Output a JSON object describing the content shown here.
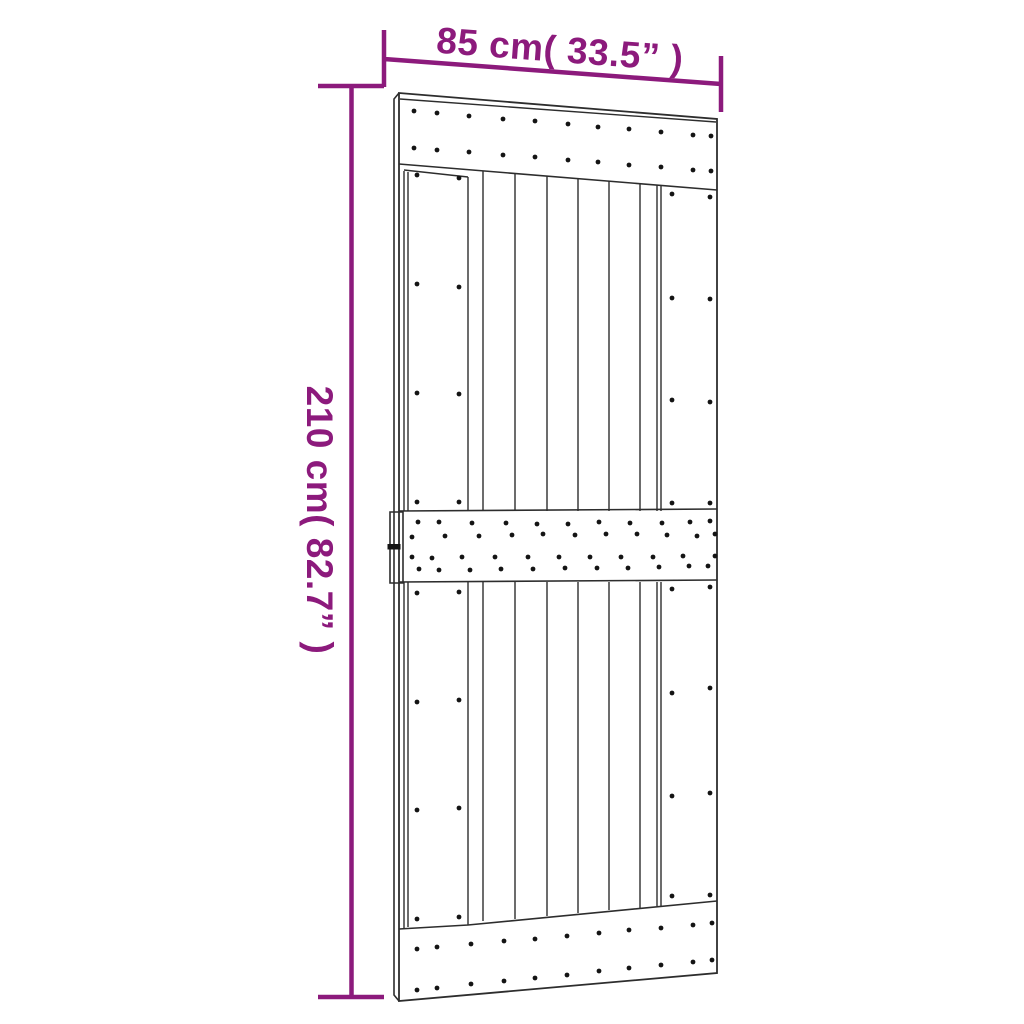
{
  "page": {
    "background": "#ffffff"
  },
  "colors": {
    "dimension": "#8c1a7c",
    "outline": "#2d2d2d",
    "screw": "#141414"
  },
  "dimensions": {
    "width": {
      "label": "85 cm( 33.5” )"
    },
    "height": {
      "label": "210 cm( 82.7” )"
    }
  },
  "door": {
    "screw_radius": 2.4,
    "screws": [
      {
        "name": "top-rail-row-1",
        "points": [
          [
            414,
            111
          ],
          [
            437,
            113
          ],
          [
            469,
            116
          ],
          [
            503,
            119
          ],
          [
            535,
            121
          ],
          [
            568,
            124
          ],
          [
            598,
            127
          ],
          [
            629,
            129
          ],
          [
            661,
            132
          ],
          [
            693,
            135
          ],
          [
            711,
            136
          ]
        ]
      },
      {
        "name": "top-rail-row-2",
        "points": [
          [
            414,
            148
          ],
          [
            437,
            150
          ],
          [
            469,
            152
          ],
          [
            503,
            155
          ],
          [
            535,
            157
          ],
          [
            568,
            160
          ],
          [
            598,
            162
          ],
          [
            629,
            165
          ],
          [
            661,
            167
          ],
          [
            693,
            170
          ],
          [
            711,
            171
          ]
        ]
      },
      {
        "name": "middle-rail-row-1",
        "points": [
          [
            418,
            522
          ],
          [
            439,
            522
          ],
          [
            472,
            523
          ],
          [
            506,
            523
          ],
          [
            537,
            524
          ],
          [
            568,
            524
          ],
          [
            599,
            522
          ],
          [
            630,
            523
          ],
          [
            662,
            523
          ],
          [
            690,
            522
          ],
          [
            710,
            521
          ]
        ]
      },
      {
        "name": "middle-rail-row-2",
        "points": [
          [
            412,
            537
          ],
          [
            445,
            536
          ],
          [
            479,
            536
          ],
          [
            512,
            535
          ],
          [
            543,
            534
          ],
          [
            575,
            535
          ],
          [
            606,
            534
          ],
          [
            637,
            534
          ],
          [
            667,
            535
          ],
          [
            697,
            536
          ],
          [
            715,
            534
          ]
        ]
      },
      {
        "name": "middle-rail-row-3",
        "points": [
          [
            412,
            557
          ],
          [
            432,
            558
          ],
          [
            462,
            557
          ],
          [
            495,
            557
          ],
          [
            528,
            557
          ],
          [
            559,
            557
          ],
          [
            590,
            557
          ],
          [
            621,
            557
          ],
          [
            653,
            557
          ],
          [
            683,
            556
          ],
          [
            715,
            556
          ]
        ]
      },
      {
        "name": "middle-rail-row-4",
        "points": [
          [
            419,
            569
          ],
          [
            439,
            570
          ],
          [
            470,
            570
          ],
          [
            501,
            569
          ],
          [
            533,
            569
          ],
          [
            565,
            568
          ],
          [
            597,
            568
          ],
          [
            628,
            568
          ],
          [
            659,
            567
          ],
          [
            689,
            566
          ],
          [
            708,
            566
          ]
        ]
      },
      {
        "name": "bottom-rail-row-1",
        "points": [
          [
            417,
            949
          ],
          [
            437,
            947
          ],
          [
            471,
            944
          ],
          [
            504,
            941
          ],
          [
            535,
            939
          ],
          [
            567,
            936
          ],
          [
            599,
            933
          ],
          [
            629,
            930
          ],
          [
            661,
            928
          ],
          [
            693,
            925
          ],
          [
            712,
            923
          ]
        ]
      },
      {
        "name": "bottom-rail-row-2",
        "points": [
          [
            417,
            990
          ],
          [
            437,
            988
          ],
          [
            471,
            984
          ],
          [
            504,
            981
          ],
          [
            535,
            978
          ],
          [
            567,
            975
          ],
          [
            599,
            971
          ],
          [
            629,
            968
          ],
          [
            661,
            965
          ],
          [
            693,
            962
          ],
          [
            712,
            960
          ]
        ]
      },
      {
        "name": "left-stile-upper",
        "points": [
          [
            417,
            175
          ],
          [
            459,
            178
          ],
          [
            417,
            284
          ],
          [
            459,
            287
          ],
          [
            417,
            393
          ],
          [
            459,
            394
          ],
          [
            417,
            502
          ],
          [
            459,
            502
          ]
        ]
      },
      {
        "name": "left-stile-lower",
        "points": [
          [
            417,
            593
          ],
          [
            459,
            592
          ],
          [
            417,
            702
          ],
          [
            459,
            700
          ],
          [
            417,
            810
          ],
          [
            459,
            808
          ],
          [
            417,
            919
          ],
          [
            459,
            917
          ]
        ]
      },
      {
        "name": "right-stile-upper",
        "points": [
          [
            672,
            194
          ],
          [
            710,
            197
          ],
          [
            672,
            298
          ],
          [
            710,
            299
          ],
          [
            672,
            400
          ],
          [
            710,
            402
          ],
          [
            672,
            503
          ],
          [
            710,
            503
          ]
        ]
      },
      {
        "name": "right-stile-lower",
        "points": [
          [
            672,
            589
          ],
          [
            710,
            587
          ],
          [
            672,
            693
          ],
          [
            710,
            688
          ],
          [
            672,
            796
          ],
          [
            710,
            793
          ],
          [
            672,
            896
          ],
          [
            710,
            895
          ]
        ]
      }
    ]
  }
}
